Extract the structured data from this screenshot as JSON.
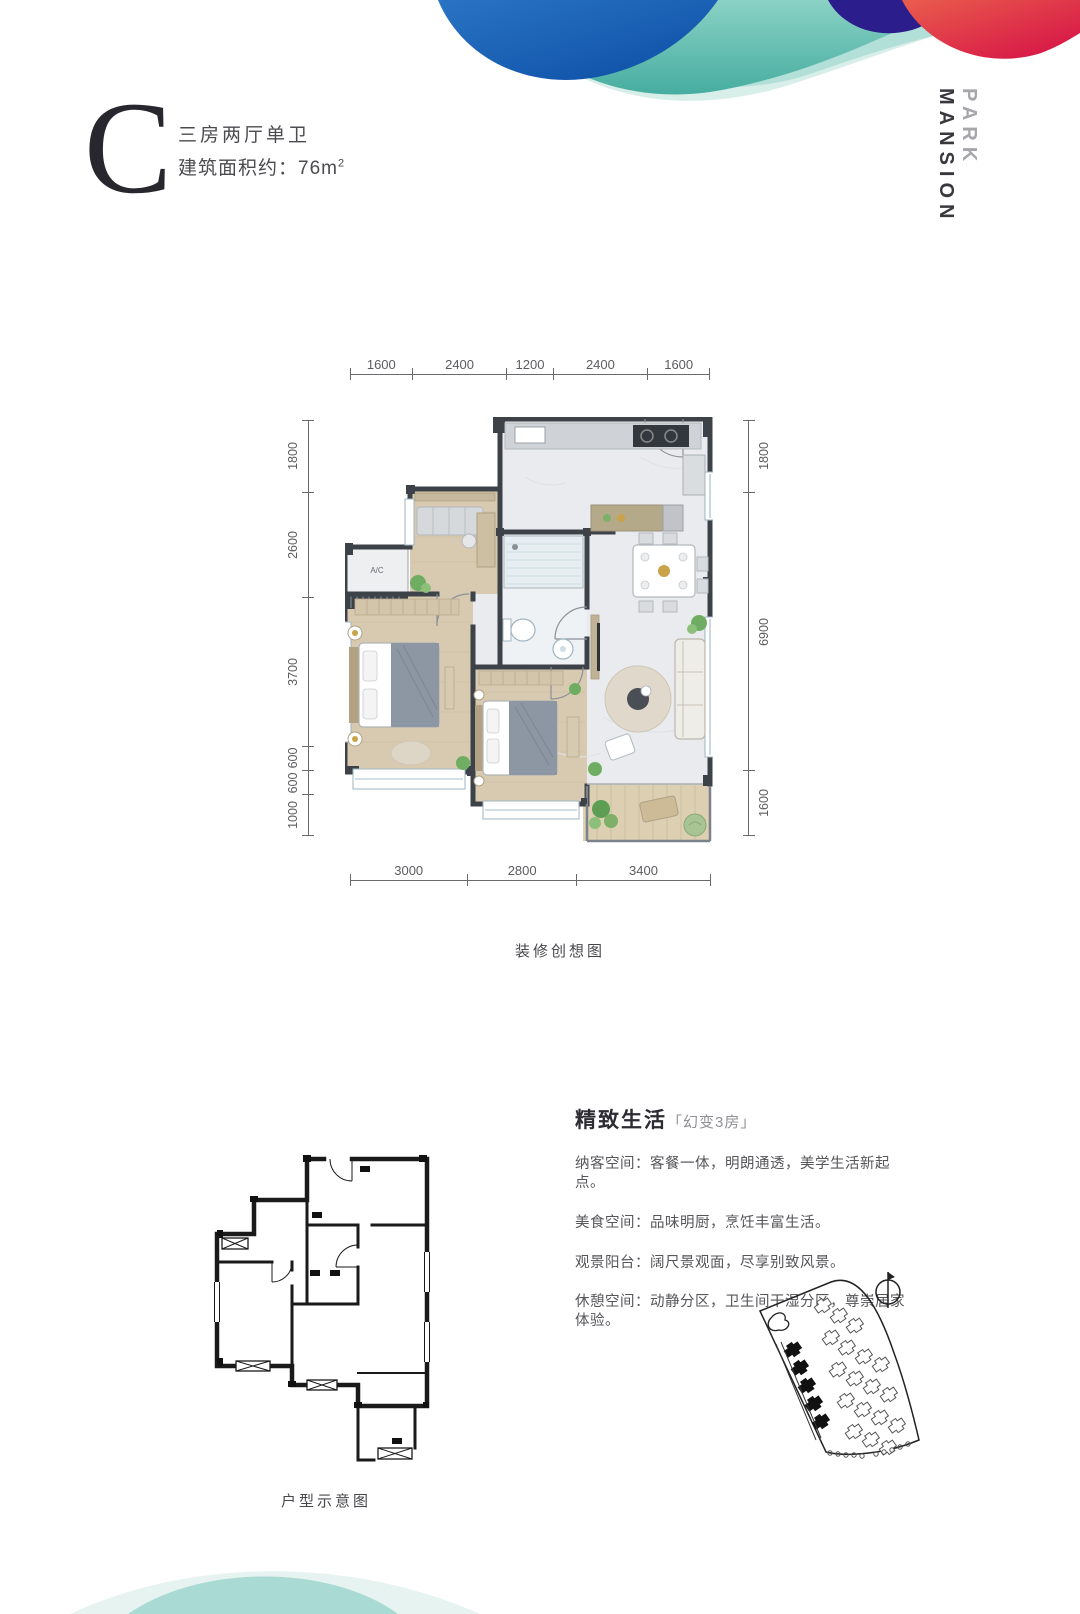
{
  "header": {
    "unit_letter": "C",
    "unit_type": "三房两厅单卫",
    "area_text": "建筑面积约：76m",
    "area_sup": "2",
    "brand_word1": "PARK",
    "brand_word2": "MANSION"
  },
  "floorplan": {
    "caption": "装修创想图",
    "ac_label": "A/C",
    "dims_top": [
      "1600",
      "2400",
      "1200",
      "2400",
      "1600"
    ],
    "dims_left": [
      "1800",
      "2600",
      "3700",
      "600",
      "600",
      "1000"
    ],
    "dims_right": [
      "1800",
      "6900",
      "1600"
    ],
    "dims_bottom": [
      "3000",
      "2800",
      "3400"
    ]
  },
  "schematic": {
    "caption": "户型示意图"
  },
  "features": {
    "title": "精致生活",
    "subtitle": "「幻变3房」",
    "items": [
      "纳客空间：客餐一体，明朗通透，美学生活新起点。",
      "美食空间：品味明厨，烹饪丰富生活。",
      "观景阳台：阔尺景观面，尽享别致风景。",
      "休憩空间：动静分区，卫生间干湿分区，尊崇居家体验。"
    ]
  },
  "colors": {
    "wave_mint": "#d8eee9",
    "wave_teal_light": "#b2e0d8",
    "wave_teal": "#55b8ab",
    "wave_green_tint": "#c8dfa4",
    "wave_blue": "#1560b2",
    "wave_purple": "#44309c",
    "wave_indigo": "#2c1d8c",
    "wave_red": "#dd1448",
    "wall": "#3d4249",
    "wood_floor": "#d8cab0",
    "common_floor": "#e9ebee",
    "text_dark": "#2c2c32",
    "text_gray": "#55555a"
  }
}
